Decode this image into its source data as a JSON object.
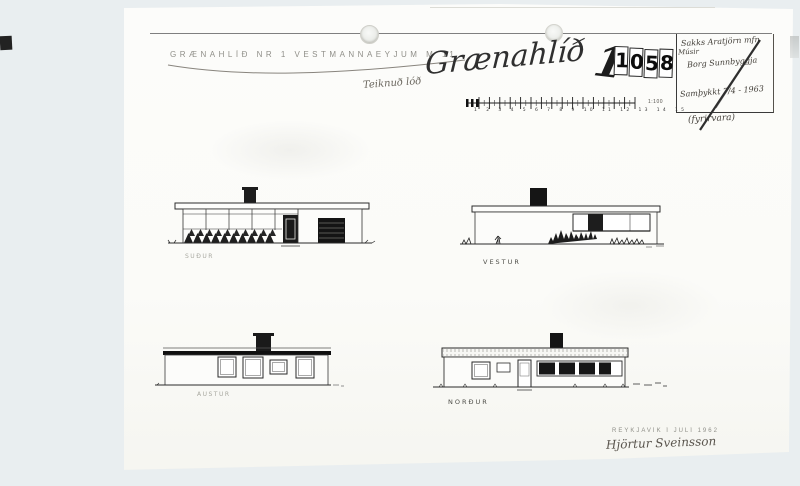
{
  "colors": {
    "background": "#e9eef0",
    "paper": "#fbfbf8",
    "ink": "#2b2b2b",
    "faded_ink": "#8e8e88",
    "stamp_ink": "#101010"
  },
  "document": {
    "typed_title": "GRÆNAHLÍÐ NR 1 VESTMANNAEYJUM M 11",
    "handwritten_title": "Grænahlíð",
    "annotation": "Teiknuð lóð",
    "stamp": {
      "handwritten_prefix": "1",
      "digits": [
        "1",
        "0",
        "5",
        "8"
      ]
    },
    "note_box": {
      "line1": "Sakks Aratjörn mfn",
      "line2": "Músir",
      "line3": "Borg Sunnbyggja",
      "line4": "Samþykkt 7/4 - 1963",
      "line5": "(fyrirvara)"
    },
    "scale_ruler": {
      "numbers": "1 2 3 4 5 6 7 8 9 10 11 12 13 14 15",
      "scale_label": "1:100"
    },
    "elevations": [
      {
        "id": "south",
        "label": "SUÐUR"
      },
      {
        "id": "west",
        "label": "VESTUR"
      },
      {
        "id": "east",
        "label": "AUSTUR"
      },
      {
        "id": "north",
        "label": "NORÐUR"
      }
    ],
    "footer": {
      "typed_line": "REYKJAVÍK Í JÚLÍ 1962",
      "signature": "Hjörtur Sveinsson"
    }
  }
}
